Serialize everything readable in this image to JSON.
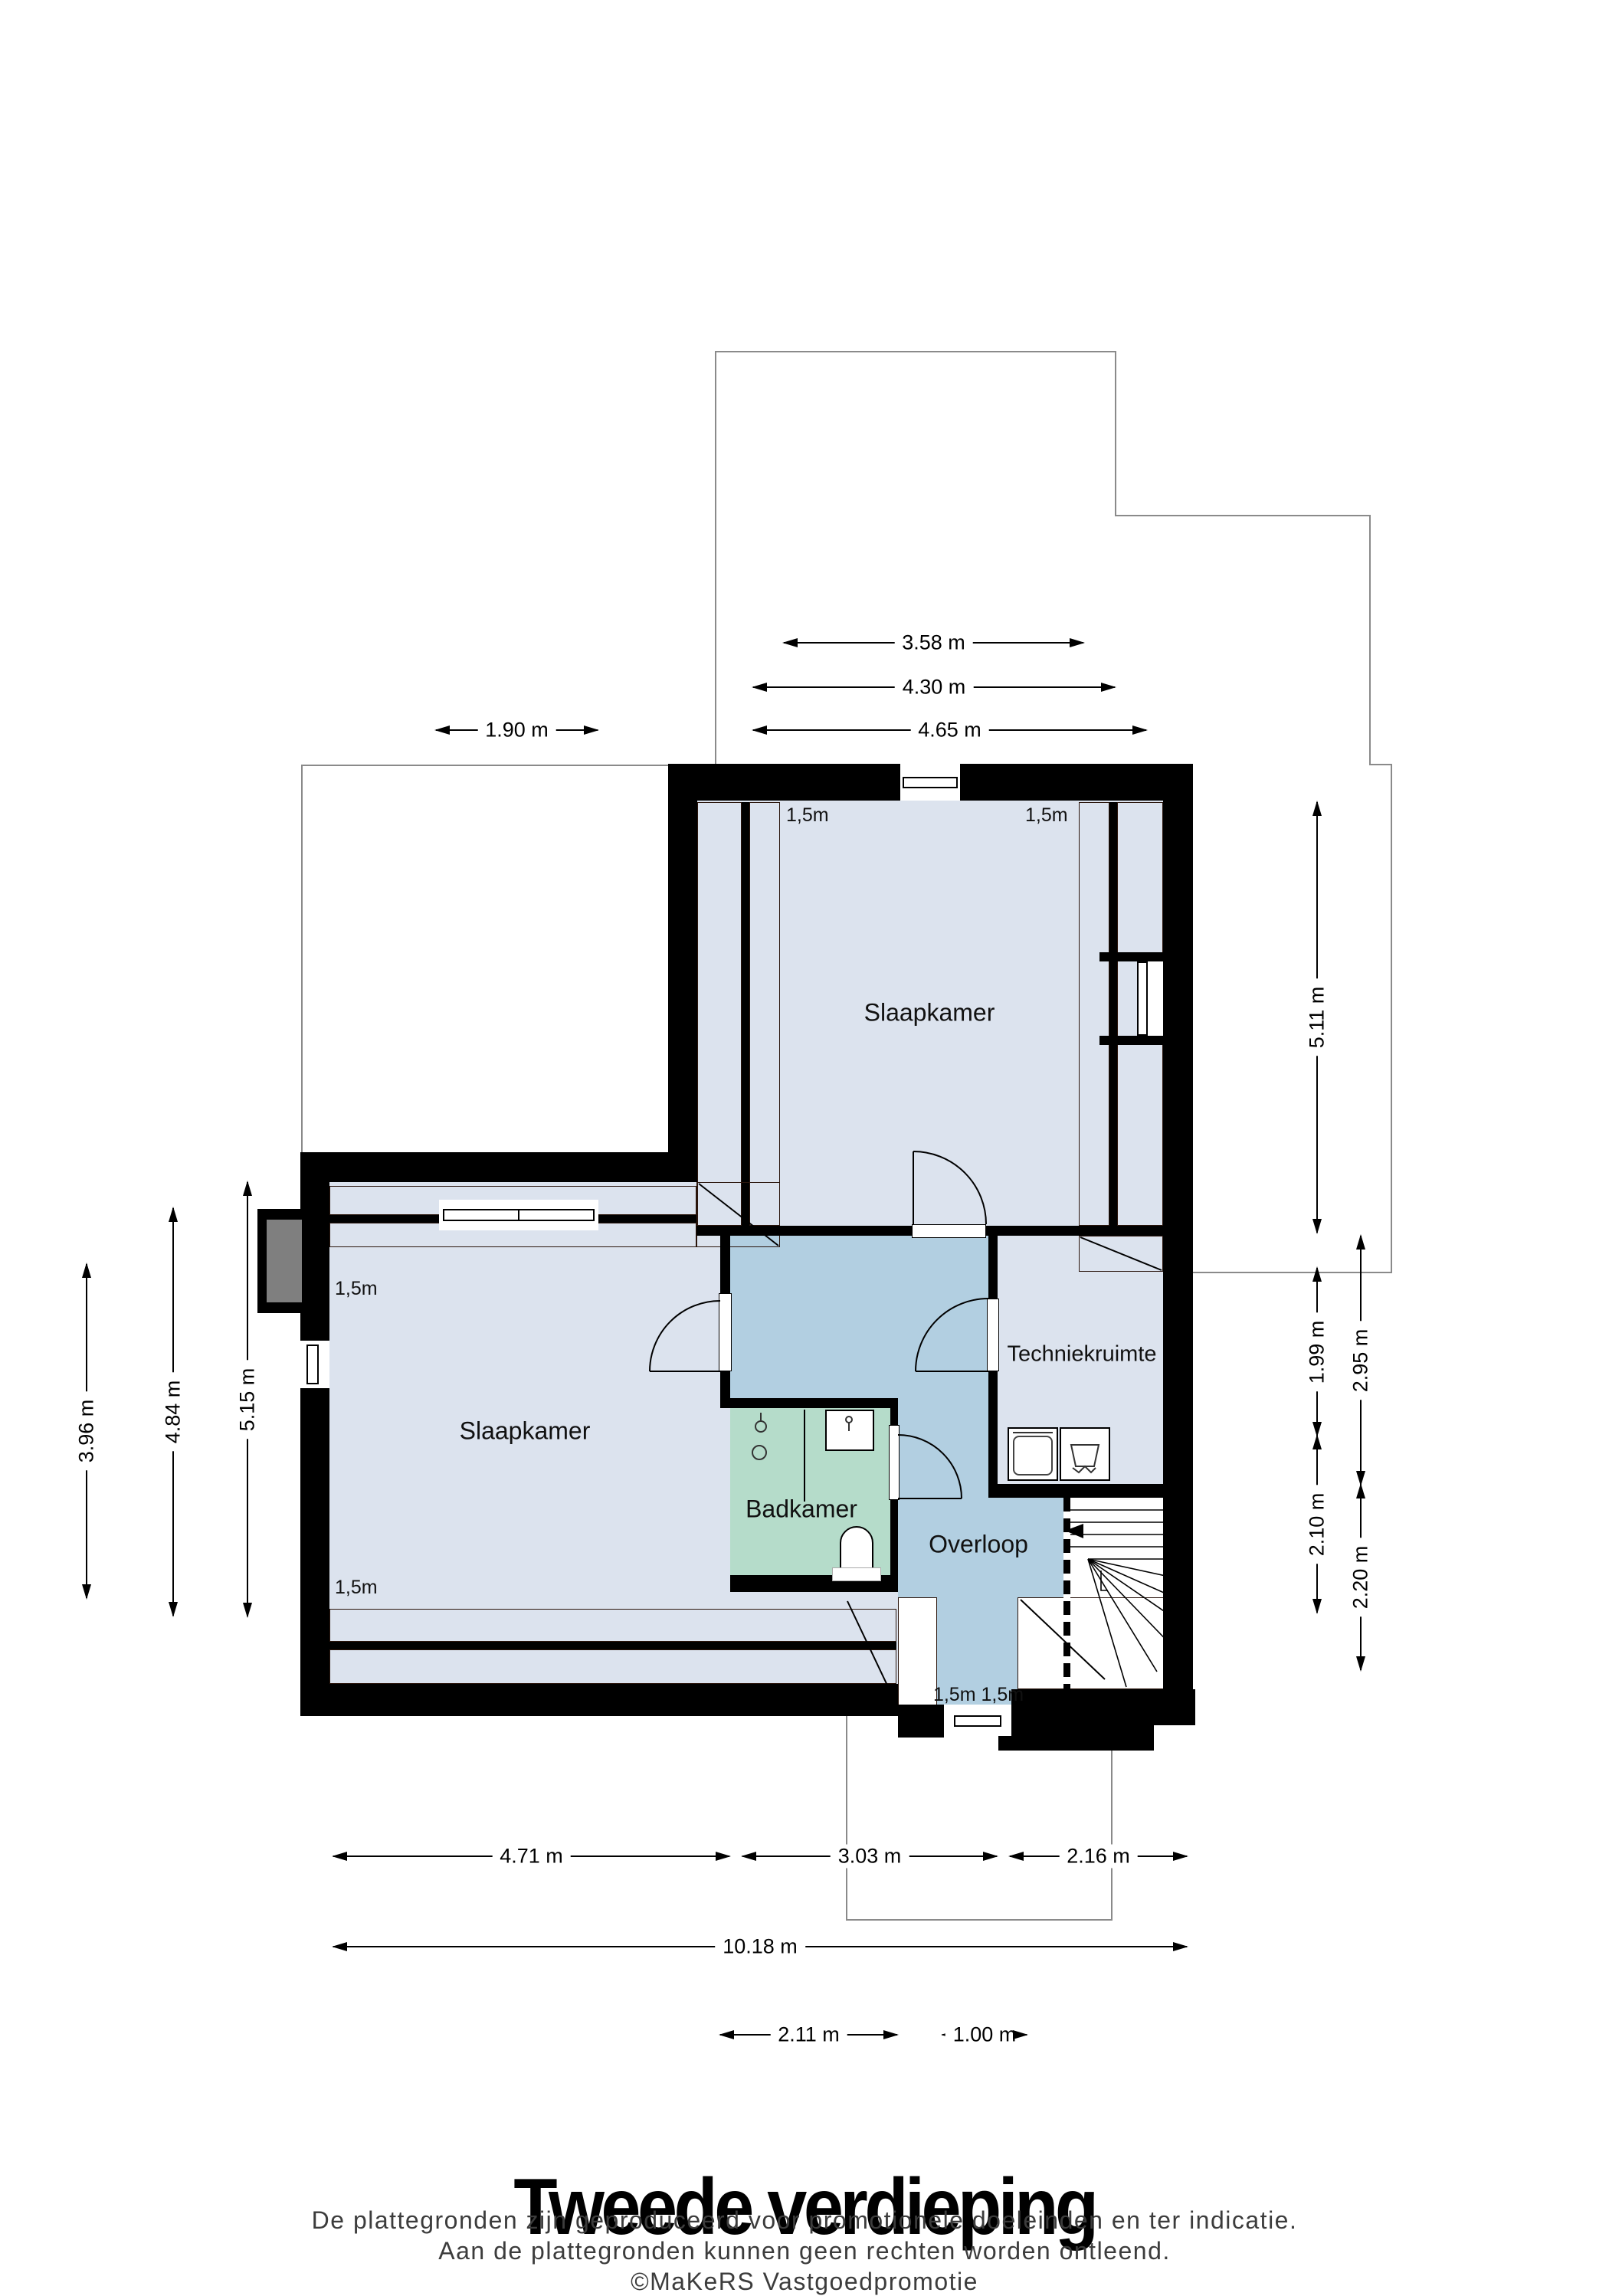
{
  "title": "Tweede verdieping",
  "disclaimer": {
    "line1": "De plattegronden zijn geproduceerd voor promotionele doeleinden en ter indicatie.",
    "line2": "Aan de plattegronden kunnen geen rechten worden ontleend.",
    "line3": "©MaKeRS Vastgoedpromotie"
  },
  "rooms": {
    "bedroom_top": "Slaapkamer",
    "bedroom_left": "Slaapkamer",
    "bathroom": "Badkamer",
    "landing": "Overloop",
    "utility": "Techniekruimte"
  },
  "height_markers": {
    "top_bedroom_left": "1,5m",
    "top_bedroom_right": "1,5m",
    "left_bedroom_upper": "1,5m",
    "left_bedroom_lower": "1,5m",
    "bottom_pair": "1,5m 1,5m"
  },
  "dimensions": {
    "top": [
      {
        "label": "3.58 m"
      },
      {
        "label": "4.30 m"
      },
      {
        "label": "4.65 m"
      },
      {
        "label": "1.90 m"
      }
    ],
    "left": [
      {
        "label": "3.96 m"
      },
      {
        "label": "4.84 m"
      },
      {
        "label": "5.15 m"
      }
    ],
    "right": [
      {
        "label": "5.11 m"
      },
      {
        "label": "1.99 m"
      },
      {
        "label": "2.10 m"
      },
      {
        "label": "2.95 m"
      },
      {
        "label": "2.20 m"
      }
    ],
    "bottom": [
      {
        "label": "4.71 m"
      },
      {
        "label": "3.03 m"
      },
      {
        "label": "2.16 m"
      },
      {
        "label": "10.18 m"
      },
      {
        "label": "2.11 m"
      },
      {
        "label": "1.00 m"
      }
    ]
  },
  "colors": {
    "room_floor": "#dce3ee",
    "landing_floor": "#b2cfe1",
    "bathroom_floor": "#b5dcca",
    "roof_tiles": "#96553c",
    "walls": "#000000",
    "roof_outline": "#8a8a8a",
    "chimney": "#7f7f7f"
  }
}
